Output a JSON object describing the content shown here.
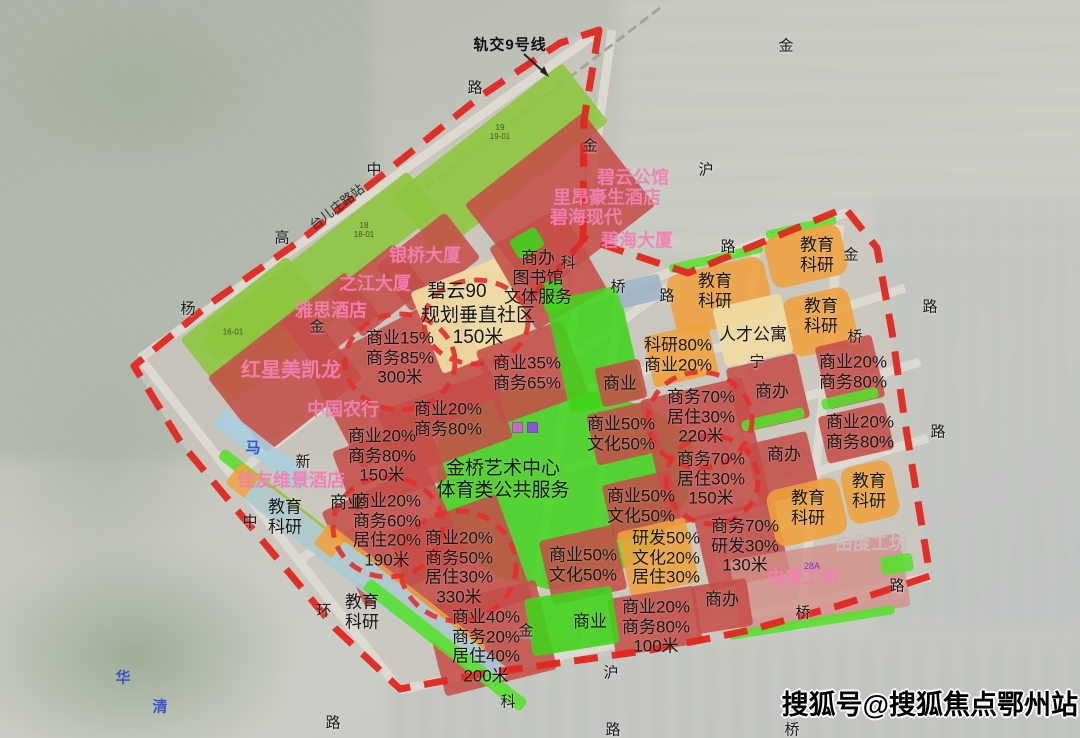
{
  "watermark": {
    "text": "搜狐号@搜狐焦点鄂州站"
  },
  "transit": {
    "line": "轨交9号线",
    "station": "台儿庄路站"
  },
  "legend_colors": {
    "boundary_red": "#e3312e",
    "commercial_office_red": "#c54f49",
    "education_research_orange": "#efa03c",
    "central_park_green": "#3fd41a",
    "parcel_green": "#8cc63c",
    "apartment_yellow": "#eedaa2",
    "workshop_pink": "#d29089",
    "canal_blue": "#a9cede"
  },
  "zone_labels": [
    {
      "text": "商业15%\n商务85%\n300米"
    },
    {
      "text": "商业35%\n商务65%"
    },
    {
      "text": "商业20%\n商务80%"
    },
    {
      "text": "商业20%\n商务80%\n150米"
    },
    {
      "text": "商业20%\n商务60%\n居住20%\n190米"
    },
    {
      "text": "商业20%\n商务50%\n居住30%\n330米"
    },
    {
      "text": "商业40%\n商务20%\n居住40%\n200米"
    },
    {
      "text": "商业50%\n文化50%"
    },
    {
      "text": "商业50%\n文化50%"
    },
    {
      "text": "商业50%\n文化50%"
    },
    {
      "text": "研发50%\n文化20%\n居住30%"
    },
    {
      "text": "科研80%\n商业20%"
    },
    {
      "text": "商务70%\n居住30%\n220米"
    },
    {
      "text": "商务70%\n居住30%\n150米"
    },
    {
      "text": "商务70%\n研发30%\n130米"
    },
    {
      "text": "商业20%\n商务80%"
    },
    {
      "text": "商业20%\n商务80%"
    },
    {
      "text": "商业20%\n商务80%\n100米"
    },
    {
      "text": "规划垂直社区\n150米"
    },
    {
      "text": "商办\n图书馆\n文体服务"
    },
    {
      "text": "碧云90"
    },
    {
      "text": "人才公寓"
    },
    {
      "text": "商办"
    },
    {
      "text": "商办"
    },
    {
      "text": "商办"
    },
    {
      "text": "商业"
    },
    {
      "text": "商业"
    },
    {
      "text": "商业"
    },
    {
      "text": "教育\n科研"
    },
    {
      "text": "教育\n科研"
    },
    {
      "text": "教育\n科研"
    },
    {
      "text": "教育\n科研"
    },
    {
      "text": "教育\n科研"
    },
    {
      "text": "教育\n科研"
    },
    {
      "text": "教育\n科研"
    },
    {
      "text": "金桥艺术中心\n体育类公共服务"
    }
  ],
  "building_labels": [
    {
      "text": "碧云公馆"
    },
    {
      "text": "里昂豪生酒店"
    },
    {
      "text": "碧海现代"
    },
    {
      "text": "碧海大厦"
    },
    {
      "text": "银桥大厦"
    },
    {
      "text": "之江大厦"
    },
    {
      "text": "雅思酒店"
    },
    {
      "text": "红星美凯龙"
    },
    {
      "text": "中国农行"
    },
    {
      "text": "佳友维景酒店"
    },
    {
      "text": "由度工坊"
    },
    {
      "text": "由度工坊"
    }
  ],
  "road_labels": [
    {
      "text": "中"
    },
    {
      "text": "金"
    },
    {
      "text": "金"
    },
    {
      "text": "沪"
    },
    {
      "text": "路"
    },
    {
      "text": "路"
    },
    {
      "text": "金"
    },
    {
      "text": "路"
    },
    {
      "text": "桥"
    },
    {
      "text": "路"
    },
    {
      "text": "高"
    },
    {
      "text": "杨"
    },
    {
      "text": "金"
    },
    {
      "text": "新"
    },
    {
      "text": "中"
    },
    {
      "text": "环"
    },
    {
      "text": "路"
    },
    {
      "text": "金"
    },
    {
      "text": "沪"
    },
    {
      "text": "科"
    },
    {
      "text": "路"
    },
    {
      "text": "桥"
    },
    {
      "text": "桥"
    },
    {
      "text": "路"
    },
    {
      "text": "科"
    },
    {
      "text": "桥"
    },
    {
      "text": "路"
    },
    {
      "text": "宁"
    }
  ],
  "river_labels": [
    {
      "text": "华"
    },
    {
      "text": "清"
    },
    {
      "text": "马"
    }
  ],
  "parcel_labels": [
    {
      "text": "19\n19-01"
    },
    {
      "text": "18\n18-01"
    },
    {
      "text": "16-01"
    },
    {
      "text": "28A"
    }
  ]
}
